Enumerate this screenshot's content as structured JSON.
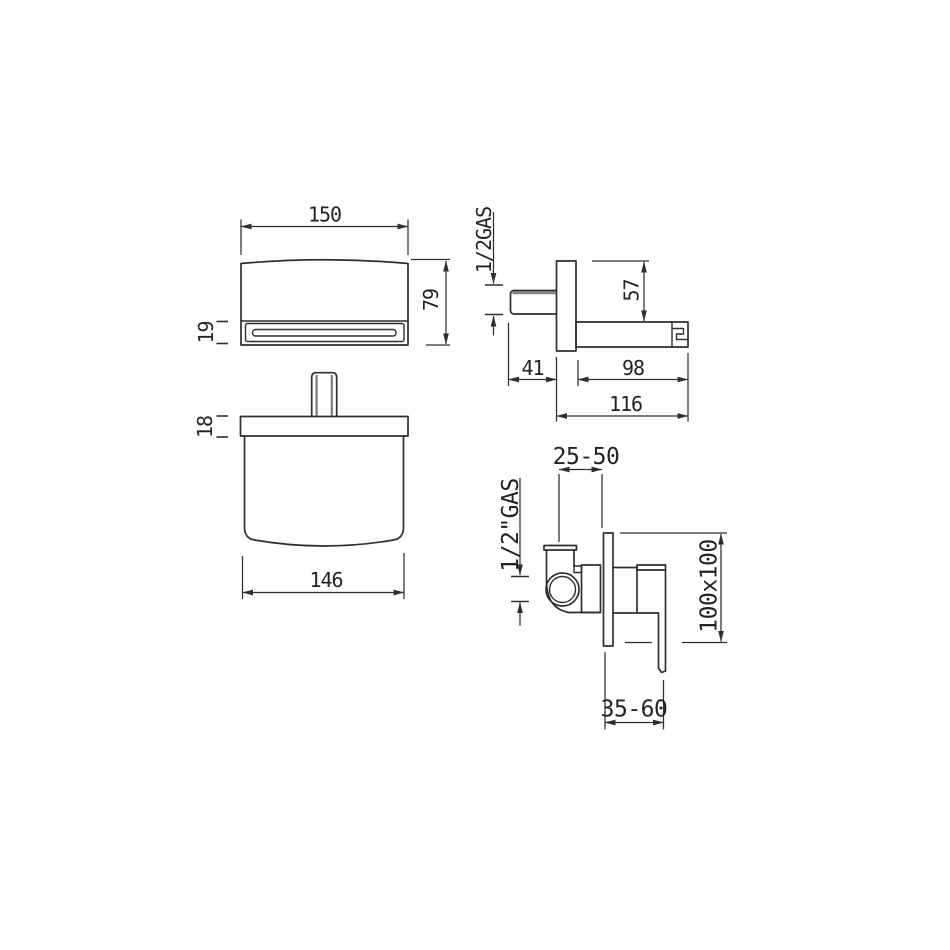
{
  "drawing_type": "technical-dimension-drawing",
  "colors": {
    "line": "#2f2f2f",
    "text": "#232323",
    "background": "#ffffff",
    "shading": "#828282"
  },
  "views": {
    "spout_front": {
      "width": "150",
      "height": "79",
      "slot_height": "19"
    },
    "spout_side": {
      "inlet_thread": "1/2GAS",
      "plate_height": "57",
      "inlet_projection": "41",
      "spout_length": "98",
      "total_projection": "116"
    },
    "spout_top": {
      "plate_thickness": "18",
      "body_width": "146"
    },
    "mixer_side": {
      "installation_depth": "25-50",
      "inlet_thread": "1/2\"GAS",
      "plate_size": "100x100",
      "handle_projection": "35-60"
    }
  }
}
